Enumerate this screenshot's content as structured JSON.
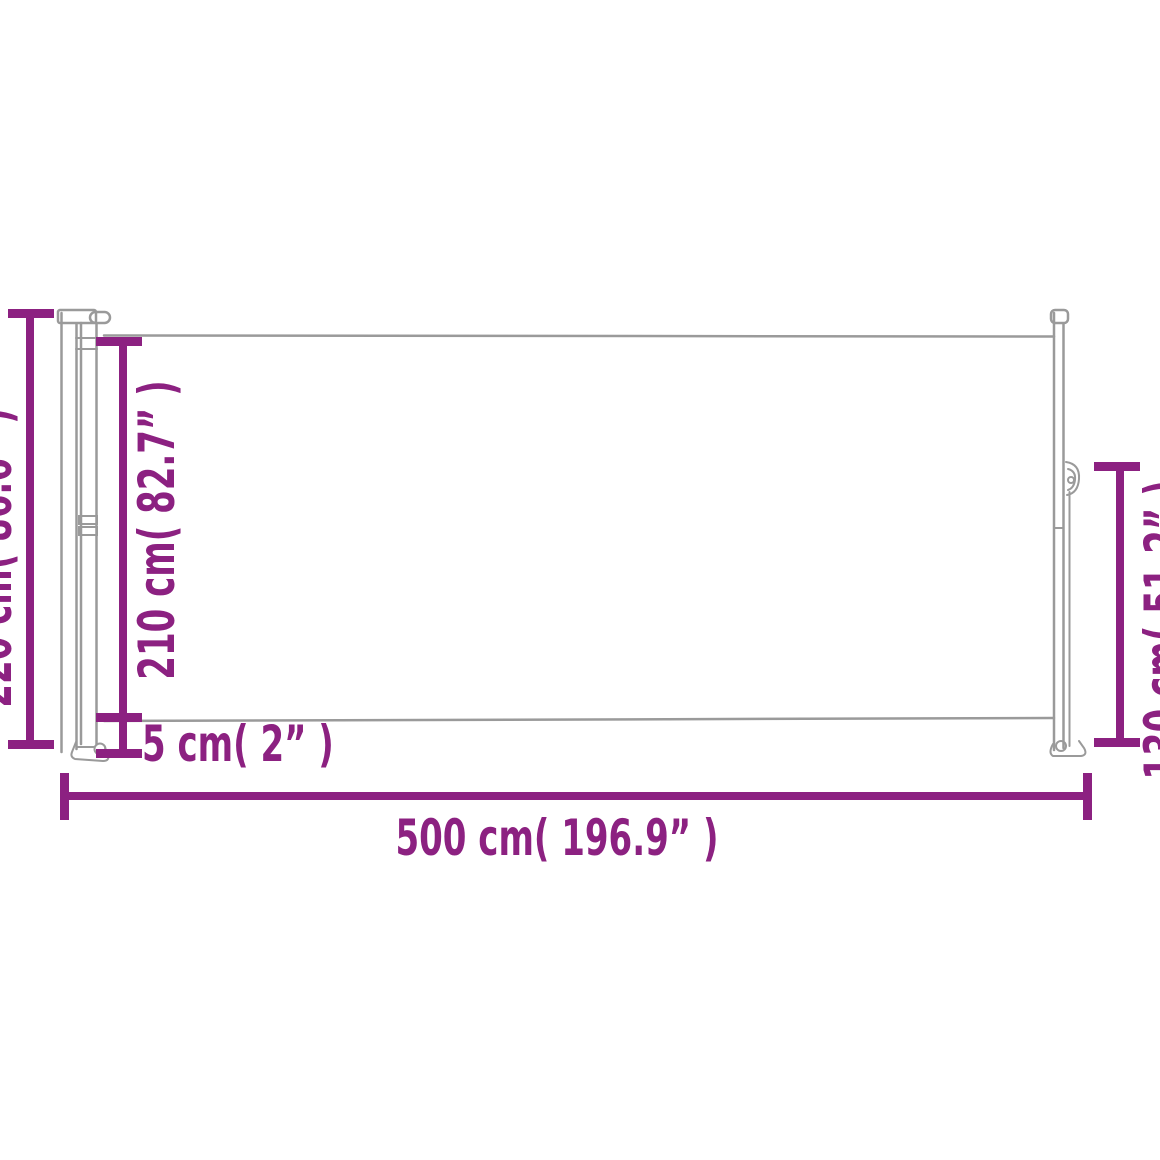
{
  "diagram": {
    "labels": {
      "height_total": "220 cm( 86.6” )",
      "height_fabric": "210 cm( 82.7” )",
      "ground_clearance": "5 cm( 2” )",
      "height_end_post": "130 cm( 51.2” )",
      "length_total": "500 cm( 196.9” )"
    },
    "colors": {
      "dimension": "#8c2181",
      "outline": "#9a9a9a",
      "background": "#ffffff"
    }
  }
}
